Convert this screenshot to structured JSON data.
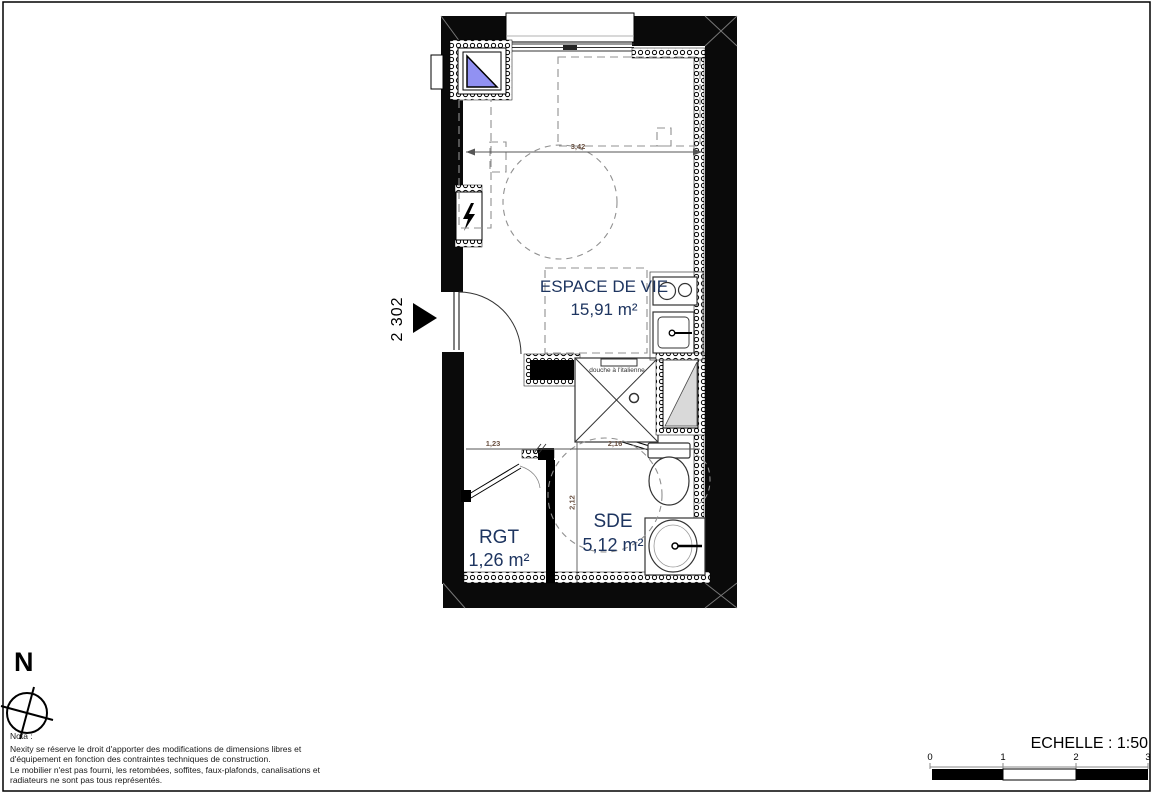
{
  "plan": {
    "unit_number": "2 302",
    "rooms": {
      "living": {
        "name": "ESPACE DE VIE",
        "area": "15,91 m²"
      },
      "storage": {
        "name": "RGT",
        "area": "1,26 m²"
      },
      "shower_room": {
        "name": "SDE",
        "area": "5,12 m²"
      }
    },
    "labels": {
      "shower": "douche à l'italienne"
    },
    "dimensions": {
      "living_width": "3,42",
      "storage_width": "1,23",
      "shower_room_width": "2,16",
      "shower_room_depth": "2,12"
    }
  },
  "compass": {
    "north_label": "N"
  },
  "nota": {
    "title": "Nota :",
    "lines": [
      "Nexity se réserve le droit d'apporter des modifications de dimensions libres et",
      "d'équipement en fonction des contraintes techniques de construction.",
      "Le mobilier n'est pas fourni, les retombées, soffites, faux-plafonds, canalisations et",
      "radiateurs ne sont pas tous représentés."
    ]
  },
  "scale_bar": {
    "label": "ECHELLE : 1:50",
    "ticks": [
      "0",
      "1",
      "2",
      "3"
    ]
  },
  "colors": {
    "wall": "#000000",
    "room_label": "#1e3560",
    "dimension_text": "#6a5142",
    "duct_fill": "#d9d9d9",
    "shutter_blue": "#9191f2"
  }
}
